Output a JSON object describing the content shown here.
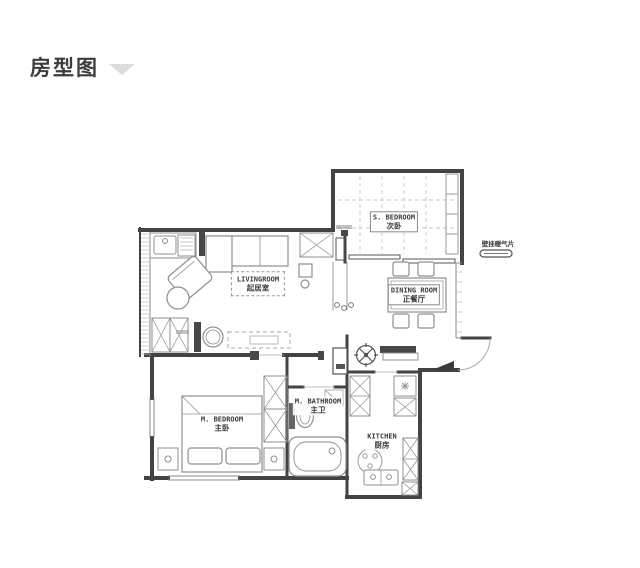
{
  "header": {
    "title": "房型图"
  },
  "floor_plan": {
    "rooms": [
      {
        "name": "s-bedroom",
        "en": "S. BEDROOM",
        "zh": "次卧"
      },
      {
        "name": "dining-room",
        "en": "DINING ROOM",
        "zh": "正餐厅"
      },
      {
        "name": "living-room",
        "en": "LIVINGROOM",
        "zh": "起居室"
      },
      {
        "name": "m-bedroom",
        "en": "M. BEDROOM",
        "zh": "主卧"
      },
      {
        "name": "m-bathroom",
        "en": "M. BATHROOM",
        "zh": "主卫"
      },
      {
        "name": "kitchen",
        "en": "KITCHEN",
        "zh": "厨房"
      }
    ],
    "annotations": [
      {
        "name": "wall-radiator",
        "text": "壁挂暖气片"
      }
    ]
  },
  "colors": {
    "wall": "#434343",
    "furniture": "#8f8f8f",
    "title": "#3d3d3d",
    "chevron": "#dcdcdc"
  }
}
